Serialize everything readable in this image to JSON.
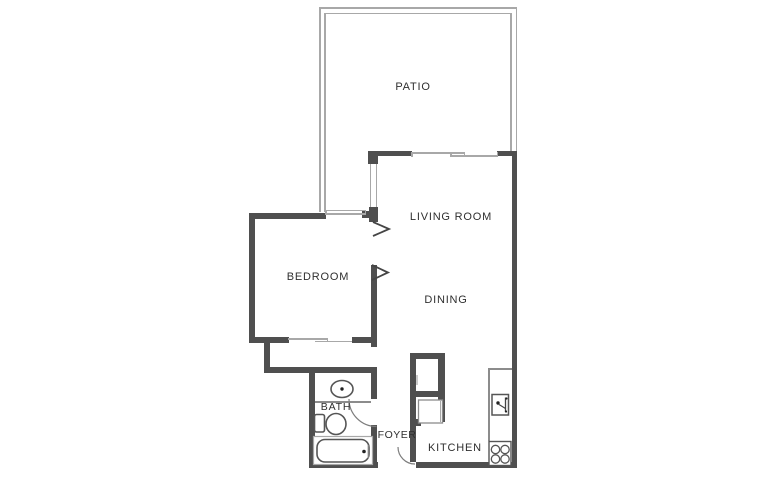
{
  "title": "Apartment floor plan",
  "rooms": {
    "patio": {
      "label": "PATIO"
    },
    "living_room": {
      "label": "LIVING ROOM"
    },
    "bedroom": {
      "label": "BEDROOM"
    },
    "dining": {
      "label": "DINING"
    },
    "bath": {
      "label": "BATH"
    },
    "foyer": {
      "label": "FOYER"
    },
    "kitchen": {
      "label": "KITCHEN"
    }
  },
  "colors": {
    "wall": "#4f4f4f",
    "thin_line": "#a8a8a8",
    "mid_line": "#8c8c8c",
    "fixture_line": "#555555",
    "text": "#2f2f2f",
    "background": "#ffffff"
  },
  "fixtures": [
    "bath-sink",
    "toilet",
    "bathtub",
    "bath-door-arc",
    "entry-door-arc",
    "door-chevron-living",
    "door-chevron-bedroom",
    "kitchen-sink",
    "stove-burners",
    "kitchen-counter",
    "closet-sliding-door",
    "patio-sliding-door",
    "bedroom-window",
    "living-room-window",
    "closet-box",
    "appliance-box"
  ]
}
